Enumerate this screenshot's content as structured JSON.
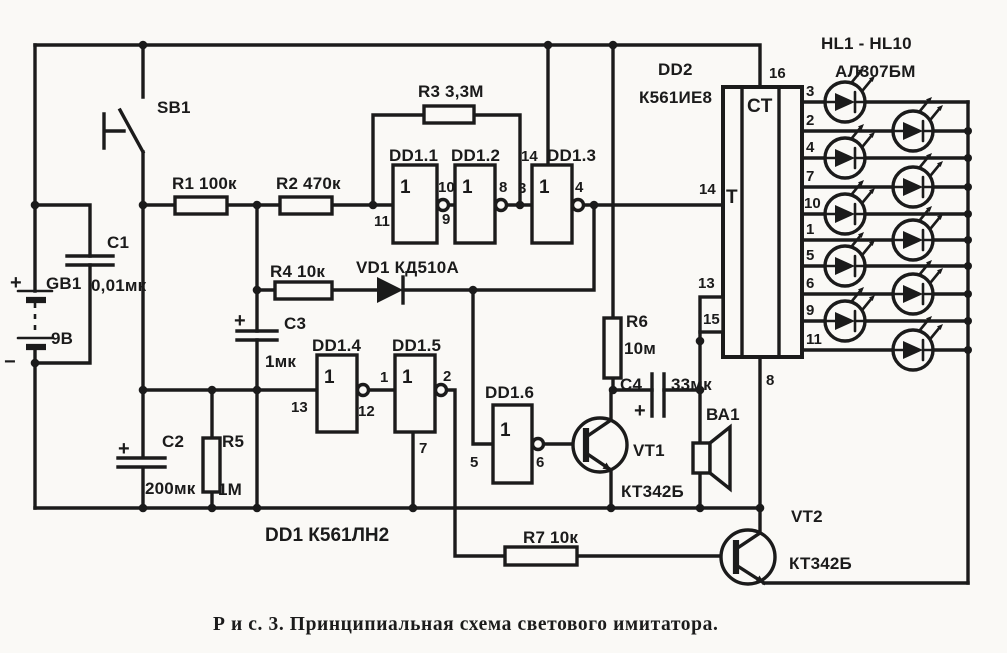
{
  "figure": {
    "caption": "Р и с. 3. Принципиальная схема светового имитатора."
  },
  "sym": {
    "plus": "+",
    "minus": "−"
  },
  "battery": {
    "ref": "GB1",
    "voltage": "9В"
  },
  "components": {
    "sb1": "SB1",
    "r1": "R1 100к",
    "r2": "R2 470к",
    "r3": "R3 3,3М",
    "r4": "R4 10к",
    "r5_ref": "R5",
    "r5_val": "1М",
    "r6_ref": "R6",
    "r6_val": "10м",
    "r7": "R7 10к",
    "c1_ref": "С1",
    "c1_val": "0,01мк",
    "c2_ref": "С2",
    "c2_val": "200мк",
    "c3_ref": "С3",
    "c3_val": "1мк",
    "c4_ref": "С4",
    "c4_val": "33мк",
    "vd1": "VD1 КД510А",
    "vt1_ref": "VT1",
    "vt1_type": "КТ342Б",
    "vt2_ref": "VT2",
    "vt2_type": "КТ342Б",
    "ba1": "ВА1"
  },
  "dd1": {
    "label": "DD1 К561ЛН2",
    "symbol": "1",
    "gates": [
      {
        "name": "DD1.1",
        "in": "11",
        "out": "10"
      },
      {
        "name": "DD1.2",
        "in": "9",
        "out": "8"
      },
      {
        "name": "DD1.3",
        "in": "3",
        "out": "4",
        "vcc": "14"
      },
      {
        "name": "DD1.4",
        "in": "13",
        "out": "12"
      },
      {
        "name": "DD1.5",
        "in": "1",
        "out": "2",
        "gnd": "7"
      },
      {
        "name": "DD1.6",
        "in": "5",
        "out": "6"
      }
    ]
  },
  "dd2": {
    "ref": "DD2",
    "part": "К561ИЕ8",
    "block": "CT",
    "input": "T",
    "pin_vcc": "16",
    "pin_clk": "14",
    "pin_13": "13",
    "pin_15": "15",
    "pin_gnd": "8",
    "outputs": [
      "3",
      "2",
      "4",
      "7",
      "10",
      "1",
      "5",
      "6",
      "9",
      "11"
    ]
  },
  "leds": {
    "range": "HL1 - HL10",
    "part": "АЛ307БМ"
  }
}
